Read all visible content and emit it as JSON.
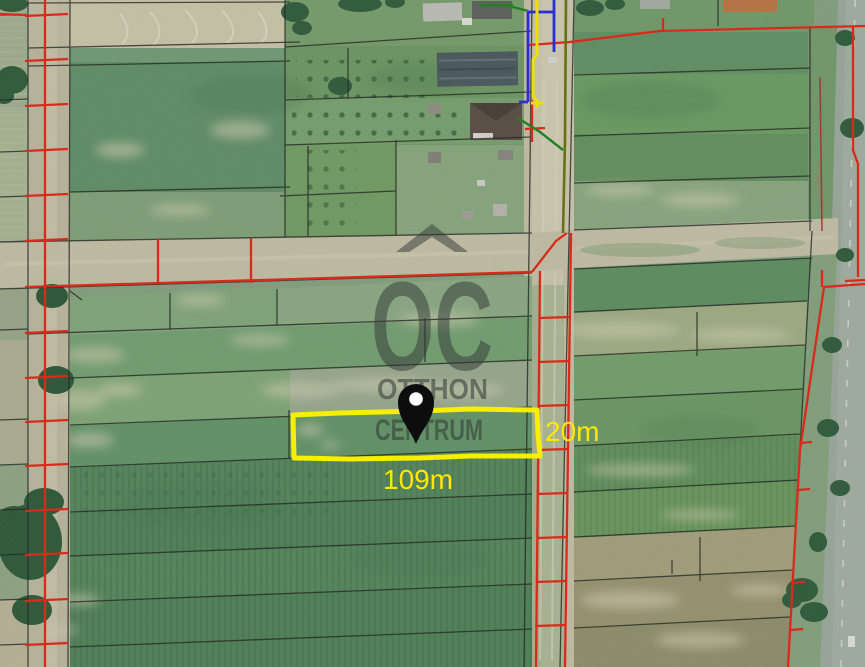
{
  "map": {
    "type": "satellite-cadastral-view",
    "watermark": {
      "logo_text": "OC",
      "line1": "OTTHON",
      "line2": "CENTRUM"
    },
    "plot": {
      "width_label": "20m",
      "length_label": "109m",
      "marker": "location-pin-icon"
    },
    "colors": {
      "highlight_yellow": "#f7ef00",
      "label_yellow": "#ffe800",
      "cadastral_red": "#dc2212",
      "parcel_black": "#1d241d",
      "utility_blue": "#2326d8",
      "utility_green": "#1b7d1b",
      "utility_olive": "#646d08",
      "watermark_gray": "#313836",
      "pin_black": "#0d0d0d"
    }
  }
}
